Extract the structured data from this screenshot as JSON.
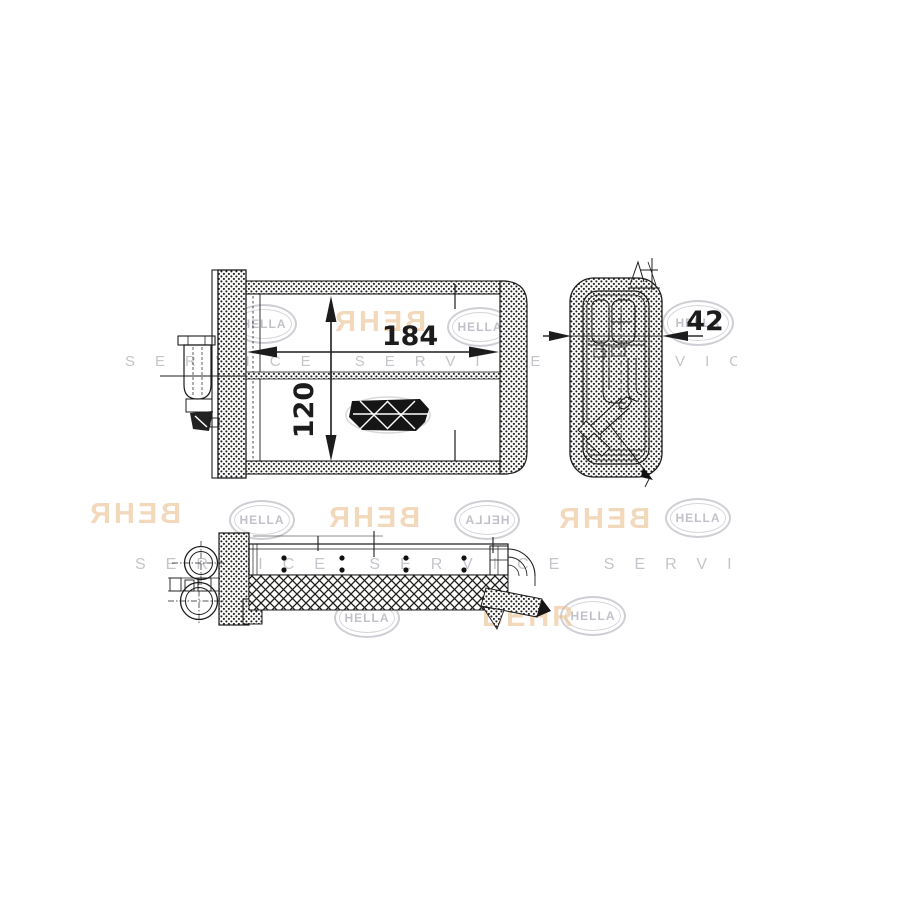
{
  "page": {
    "background": "#ffffff",
    "canvas_width": 900,
    "canvas_height": 900
  },
  "drawing": {
    "title": "Heater core technical drawing with front, side and bottom views",
    "dimensions": {
      "width_mm": "184",
      "height_mm": "120",
      "depth_mm": "42"
    },
    "colors": {
      "line": "#1c1c1c",
      "watermark_gray": "#a5a7b0",
      "watermark_orange": "#e9b985"
    }
  },
  "watermark": {
    "hella": "HELLA",
    "behr": "BEHR",
    "service": "SERVICE SERVICE SERVICE"
  }
}
